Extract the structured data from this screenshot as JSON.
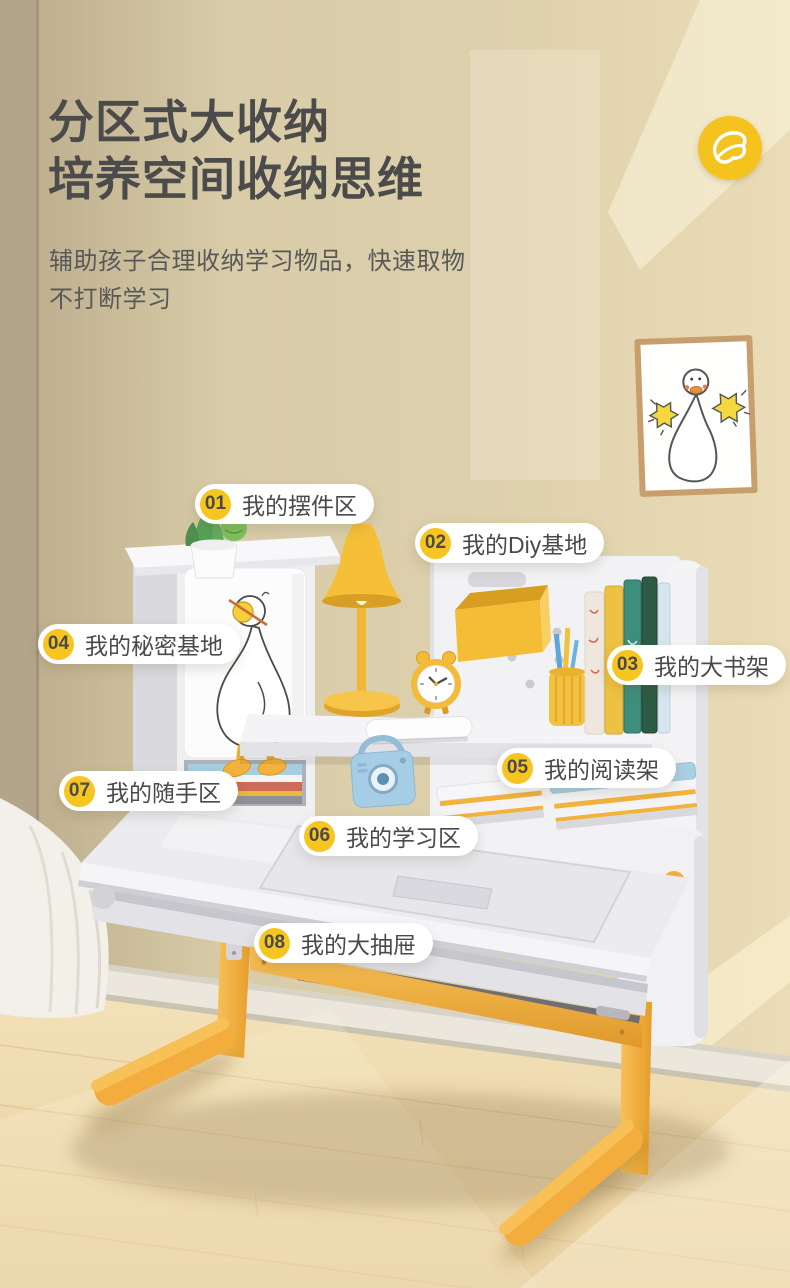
{
  "header": {
    "title_line1": "分区式大收纳",
    "title_line2": "培养空间收纳思维",
    "subtitle_line1": "辅助孩子合理收纳学习物品，快速取物",
    "subtitle_line2": "不打断学习"
  },
  "logo": {
    "name": "duck-foot-brand-logo",
    "bg_color": "#F5C31D"
  },
  "callouts": [
    {
      "num": "01",
      "label": "我的摆件区"
    },
    {
      "num": "02",
      "label": "我的Diy基地"
    },
    {
      "num": "03",
      "label": "我的大书架"
    },
    {
      "num": "04",
      "label": "我的秘密基地"
    },
    {
      "num": "05",
      "label": "我的阅读架"
    },
    {
      "num": "06",
      "label": "我的学习区"
    },
    {
      "num": "07",
      "label": "我的随手区"
    },
    {
      "num": "08",
      "label": "我的大抽屉"
    }
  ],
  "scene": {
    "subject": "kids study desk with hutch storage zones, yellow legs, duck wall art",
    "palette": {
      "accent_yellow": "#F5C31D",
      "leg_orange": "#F2A93B",
      "accent_blue": "#A8CFE3",
      "wall": "#D9CDAB",
      "floor": "#F0DDB2",
      "desk_white": "#F2F2F5",
      "text_dark": "#4B4B4B"
    }
  }
}
